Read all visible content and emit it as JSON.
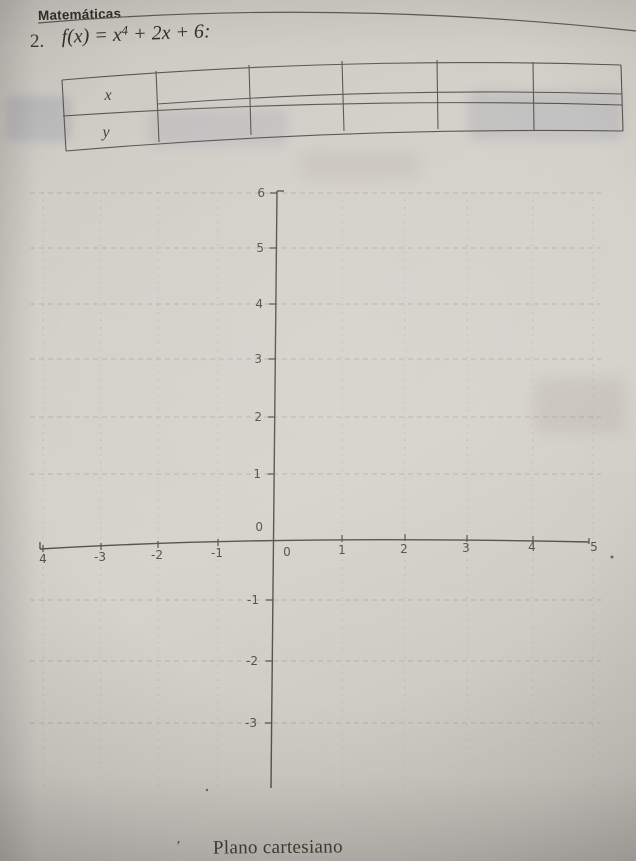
{
  "header": {
    "title": "Matemáticas"
  },
  "problem": {
    "number": "2.",
    "formula_prefix": "f(x) = x",
    "formula_exponent": "4",
    "formula_suffix": " + 2x + 6:"
  },
  "table": {
    "row_labels": [
      "x",
      "y"
    ],
    "num_columns": 6,
    "cells": [
      [
        "",
        "",
        "",
        "",
        ""
      ],
      [
        "",
        "",
        "",
        "",
        ""
      ]
    ]
  },
  "plane": {
    "caption": "Plano cartesiano",
    "y_tick_labels": [
      "6",
      "5",
      "4",
      "3",
      "2",
      "1",
      "0",
      "-1",
      "-2",
      "-3"
    ],
    "x_tick_labels": [
      "4",
      "-3",
      "-2",
      "-1",
      "0",
      "1",
      "2",
      "3",
      "4",
      "5"
    ],
    "apostrophe_mark": "’"
  },
  "chart_data": {
    "type": "scatter",
    "title": "Plano cartesiano",
    "series": [],
    "x": [],
    "y": [],
    "xlim": [
      -4,
      5
    ],
    "ylim": [
      -3,
      6
    ],
    "x_ticks": [
      -4,
      -3,
      -2,
      -1,
      0,
      1,
      2,
      3,
      4,
      5
    ],
    "y_ticks": [
      -3,
      -2,
      -1,
      0,
      1,
      2,
      3,
      4,
      5,
      6
    ],
    "grid": "dashed",
    "note": "empty cartesian plane with no plotted points"
  },
  "colors": {
    "paper": "#d3d0c9",
    "ink": "#33312b",
    "axis": "#56534c",
    "grid": "#a09c92",
    "show_through": "#626e94"
  }
}
